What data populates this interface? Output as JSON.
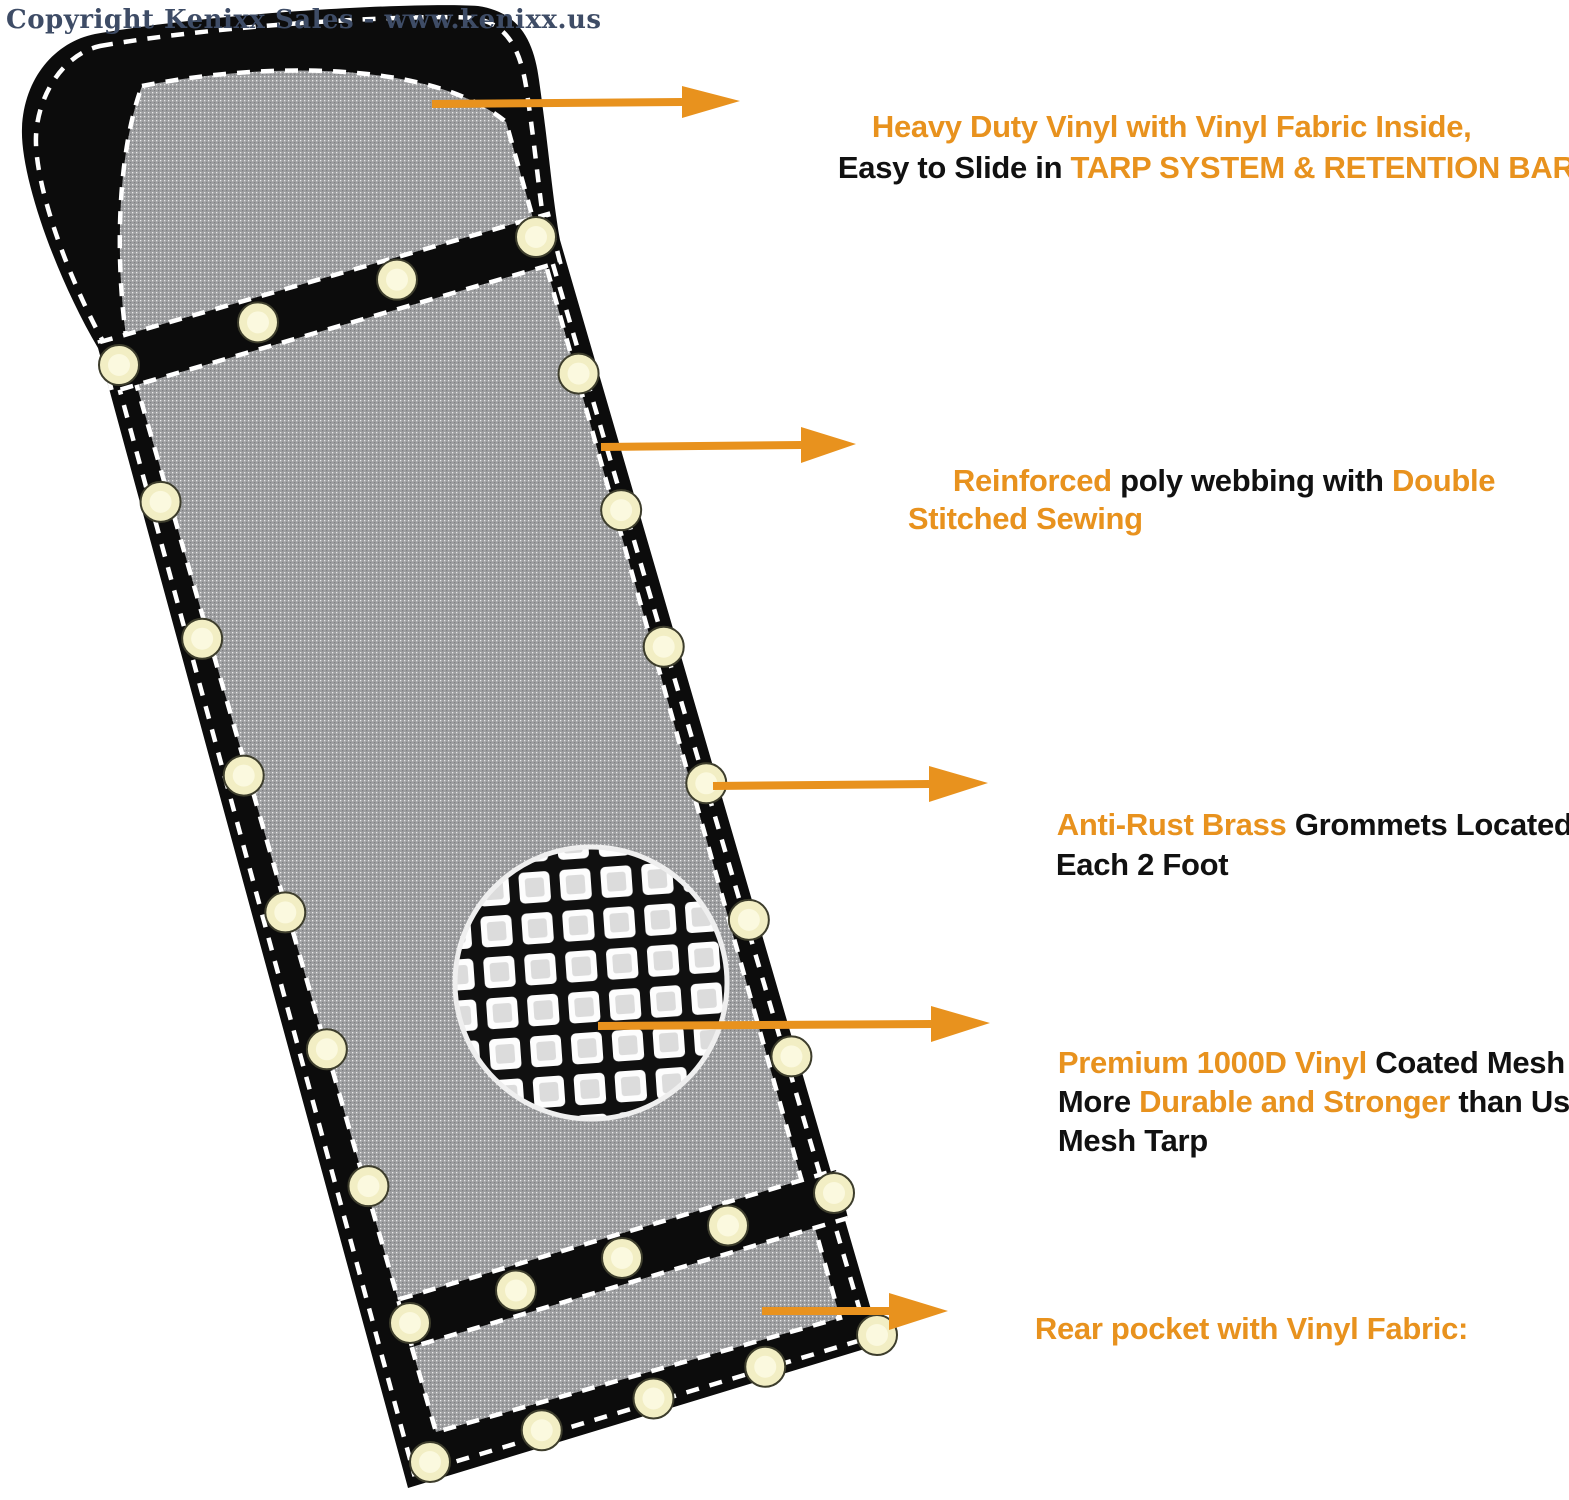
{
  "copyright": "Copyright Kenixx Sales - www.kenixx.us",
  "colors": {
    "accent": "#E8921E",
    "text_dark": "#111111",
    "copyright": "#3E4C66",
    "webbing": "#0C0C0C",
    "mesh_base": "#9D9EA0",
    "grommet": "#F2EEC4",
    "grommet_inner": "#FBF9DF",
    "stitch": "#FFFFFF",
    "background": "#FFFFFF"
  },
  "figure": {
    "subject": "mesh tarp with reinforced webbing, grommets and magnified mesh inset",
    "arrow_count": 5
  },
  "annotations": [
    {
      "name": "pocket-callout",
      "lines": [
        {
          "segments": [
            {
              "text": "Heavy Duty Vinyl with Vinyl Fabric Inside,",
              "tone": "accent"
            }
          ]
        },
        {
          "segments": [
            {
              "text": "Easy to Slide in ",
              "tone": "dark"
            },
            {
              "text": "TARP SYSTEM & RETENTION BAR",
              "tone": "accent"
            }
          ]
        }
      ]
    },
    {
      "name": "webbing-callout",
      "lines": [
        {
          "segments": [
            {
              "text": "Reinforced ",
              "tone": "accent"
            },
            {
              "text": "poly webbing with ",
              "tone": "dark"
            },
            {
              "text": "Double",
              "tone": "accent"
            }
          ]
        },
        {
          "segments": [
            {
              "text": "Stitched Sewing",
              "tone": "accent"
            }
          ]
        }
      ]
    },
    {
      "name": "grommet-callout",
      "lines": [
        {
          "segments": [
            {
              "text": "Anti-Rust Brass ",
              "tone": "accent"
            },
            {
              "text": "Grommets Located",
              "tone": "dark"
            }
          ]
        },
        {
          "segments": [
            {
              "text": "Each 2 Foot",
              "tone": "dark"
            }
          ]
        }
      ]
    },
    {
      "name": "mesh-callout",
      "lines": [
        {
          "segments": [
            {
              "text": "Premium 1000D Vinyl ",
              "tone": "accent"
            },
            {
              "text": "Coated Mesh",
              "tone": "dark"
            }
          ]
        },
        {
          "segments": [
            {
              "text": "More ",
              "tone": "dark"
            },
            {
              "text": "Durable and Stronger ",
              "tone": "accent"
            },
            {
              "text": "than Usual",
              "tone": "dark"
            }
          ]
        },
        {
          "segments": [
            {
              "text": "Mesh Tarp",
              "tone": "dark"
            }
          ]
        }
      ]
    },
    {
      "name": "rear-pocket-callout",
      "lines": [
        {
          "segments": [
            {
              "text": "Rear pocket with Vinyl Fabric:",
              "tone": "accent"
            }
          ]
        }
      ]
    }
  ]
}
